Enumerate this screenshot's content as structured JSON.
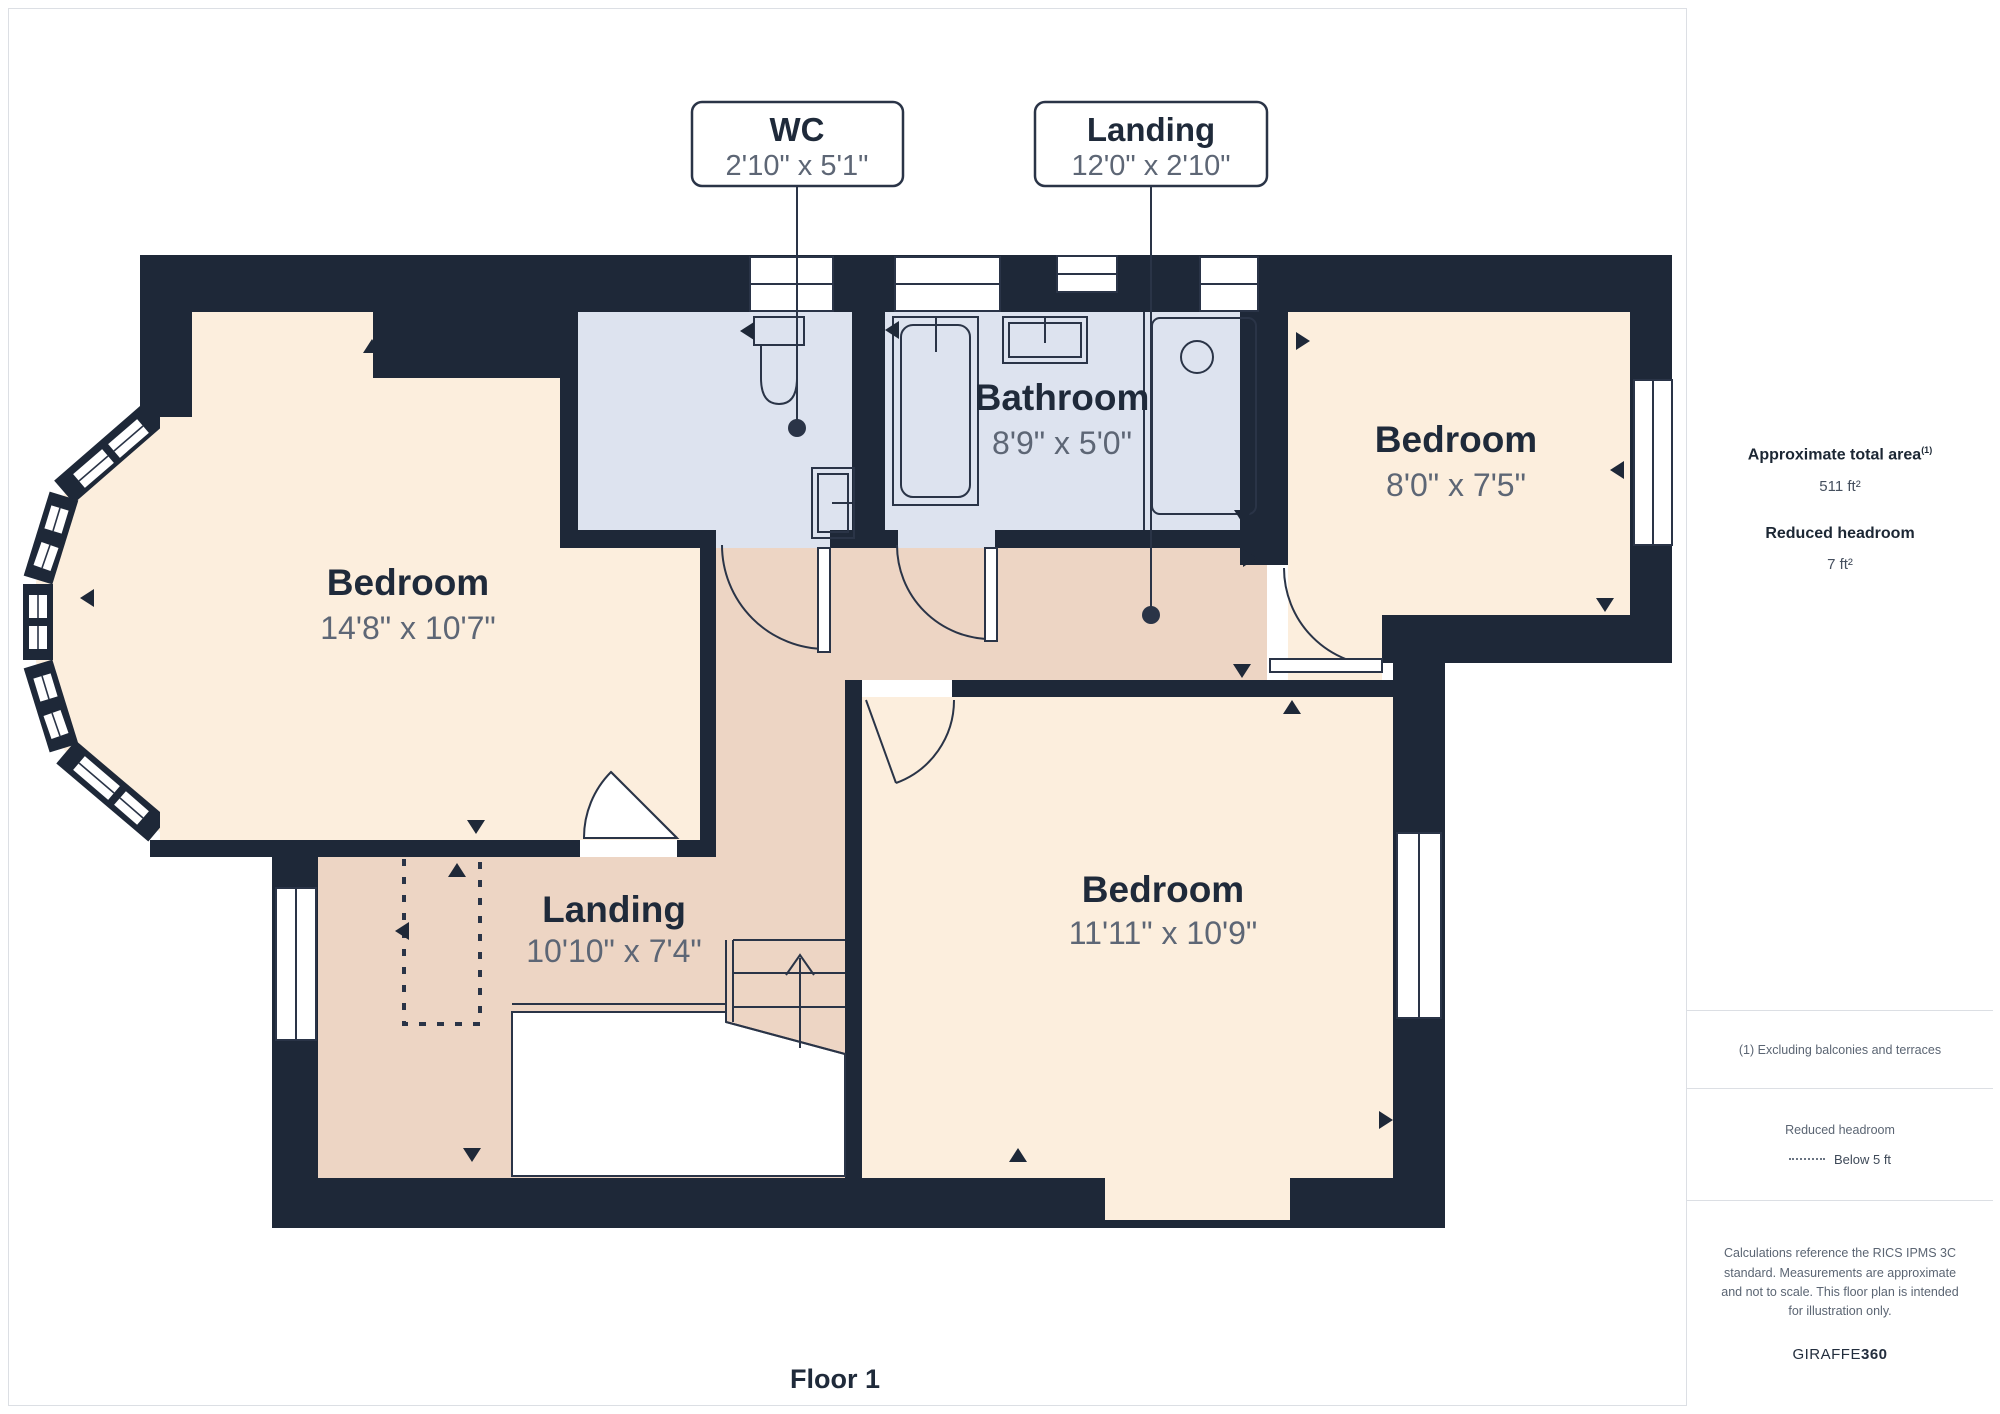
{
  "floor_label": "Floor 1",
  "callouts": [
    {
      "title": "WC",
      "dims": "2'10\" x 5'1\""
    },
    {
      "title": "Landing",
      "dims": "12'0\" x 2'10\""
    }
  ],
  "rooms": [
    {
      "name": "Bedroom",
      "dims": "14'8\" x 10'7\""
    },
    {
      "name": "Bathroom",
      "dims": "8'9\" x 5'0\""
    },
    {
      "name": "Bedroom",
      "dims": "8'0\" x 7'5\""
    },
    {
      "name": "Landing",
      "dims": "10'10\" x 7'4\""
    },
    {
      "name": "Bedroom",
      "dims": "11'11\" x 10'9\""
    }
  ],
  "sidebar": {
    "total_area_label": "Approximate total area",
    "total_area_sup": "(1)",
    "total_area_value": "511 ft²",
    "reduced_headroom_label": "Reduced headroom",
    "reduced_headroom_value": "7 ft²",
    "footnote": "(1) Excluding balconies and terraces",
    "legend_title": "Reduced headroom",
    "legend_item": "Below 5 ft",
    "disclaimer": "Calculations reference the RICS IPMS 3C standard. Measurements are approximate and not to scale. This floor plan is intended for illustration only.",
    "brand": "GIRAFFE",
    "brand_bold": "360"
  },
  "colors": {
    "wall": "#1e2838",
    "bedroom_fill": "#fceedd",
    "hallway_fill": "#edd5c4",
    "bathroom_fill": "#dde3ef",
    "stroke": "#2a3447",
    "dims_text": "#5d6675",
    "title_text": "#1f2a3a",
    "divider": "#dcdfe4"
  }
}
